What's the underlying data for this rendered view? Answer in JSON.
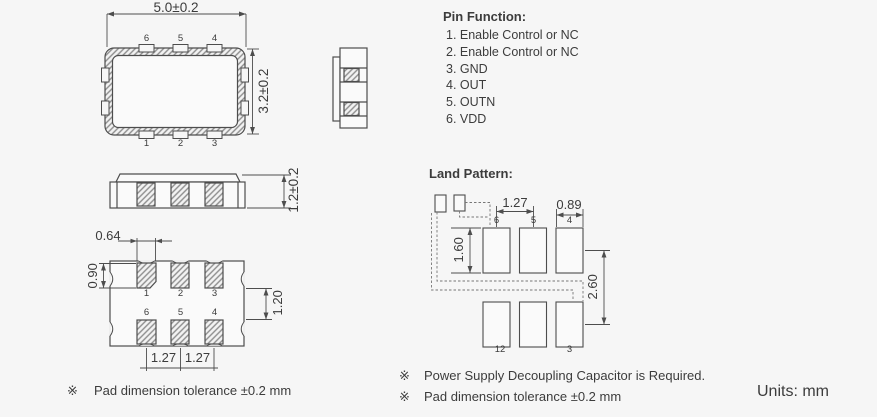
{
  "colors": {
    "background": "#f6f6f6",
    "line": "#4d4d4d",
    "text": "#3c3c3c",
    "hatch_line": "#8d8d8d"
  },
  "top_view": {
    "width_dim": "5.0±0.2",
    "height_dim": "3.2±0.2",
    "top_pins": [
      "6",
      "5",
      "4"
    ],
    "bottom_pins": [
      "1",
      "2",
      "3"
    ]
  },
  "side_view": {
    "height_dim": "1.2±0.2"
  },
  "bottom_view": {
    "pad_width_dim": "0.64",
    "pad_height_dim": "0.90",
    "row_gap_dim": "1.20",
    "pitch_left_dim": "1.27",
    "pitch_right_dim": "1.27",
    "top_row_pins": [
      "1",
      "2",
      "3"
    ],
    "bottom_row_pins": [
      "6",
      "5",
      "4"
    ]
  },
  "pin_function": {
    "title": "Pin Function:",
    "items": [
      "1. Enable Control or NC",
      "2. Enable Control or NC",
      "3. GND",
      "4. OUT",
      "5. OUTN",
      "6. VDD"
    ]
  },
  "land_pattern": {
    "title": "Land Pattern:",
    "pitch_dim": "1.27",
    "pad_width_dim": "0.89",
    "pad_height_dim": "1.60",
    "row_spacing_dim": "2.60",
    "top_row_labels": [
      "6",
      "5",
      "4"
    ],
    "bottom_left_label": "12",
    "bottom_right_label": "3"
  },
  "notes": {
    "left_marker": "※",
    "left_text": "Pad dimension tolerance ±0.2 mm",
    "right": [
      {
        "marker": "※",
        "text": "Power Supply Decoupling Capacitor is Required."
      },
      {
        "marker": "※",
        "text": "Pad dimension tolerance ±0.2 mm"
      }
    ],
    "units": "Units: mm"
  }
}
